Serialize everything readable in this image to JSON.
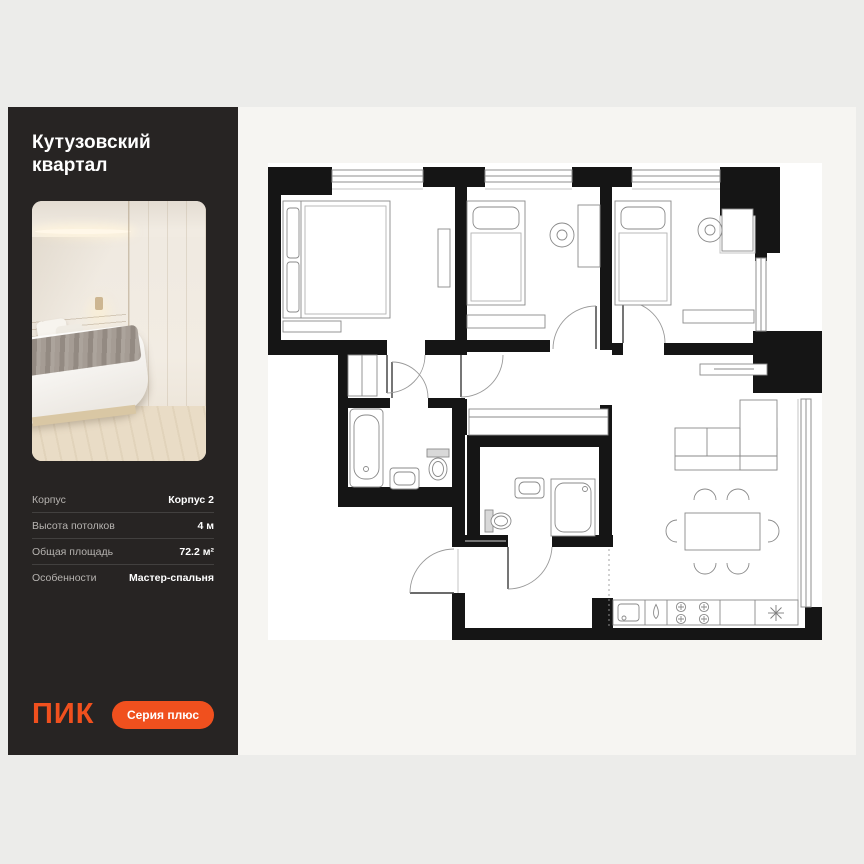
{
  "sidebar": {
    "title": "Кутузовский квартал",
    "photo_icon": "bedroom-photo",
    "details": [
      {
        "label": "Корпус",
        "value": "Корпус 2"
      },
      {
        "label": "Высота потолков",
        "value": "4 м"
      },
      {
        "label": "Общая площадь",
        "value": "72.2 м²"
      },
      {
        "label": "Особенности",
        "value": "Мастер-спальня"
      }
    ],
    "logo_text": "ПИК",
    "badge_label": "Серия плюс"
  },
  "colors": {
    "accent": "#F0501E",
    "sidebar_bg": "#272423",
    "panel_bg": "#F6F5F2",
    "page_bg": "#ECECEA",
    "wall": "#151515",
    "paper": "#FFFFFF"
  },
  "floorplan": {
    "type": "apartment-floor-plan",
    "rooms": [
      "master-bedroom",
      "bedroom-2",
      "bedroom-3",
      "bathroom",
      "shower-room",
      "wardrobe-room",
      "hallway",
      "kitchen-living-room"
    ],
    "fixture_icons": [
      "double-bed",
      "single-bed",
      "single-bed",
      "desk-chair",
      "desk-chair",
      "bathtub",
      "sink",
      "toilet",
      "sink",
      "toilet",
      "shower",
      "wardrobe",
      "l-sofa",
      "tv-console",
      "dining-table-6-chairs",
      "kitchen-sink",
      "tap-droplet",
      "stove-4-burners",
      "fridge-snowflake"
    ]
  }
}
